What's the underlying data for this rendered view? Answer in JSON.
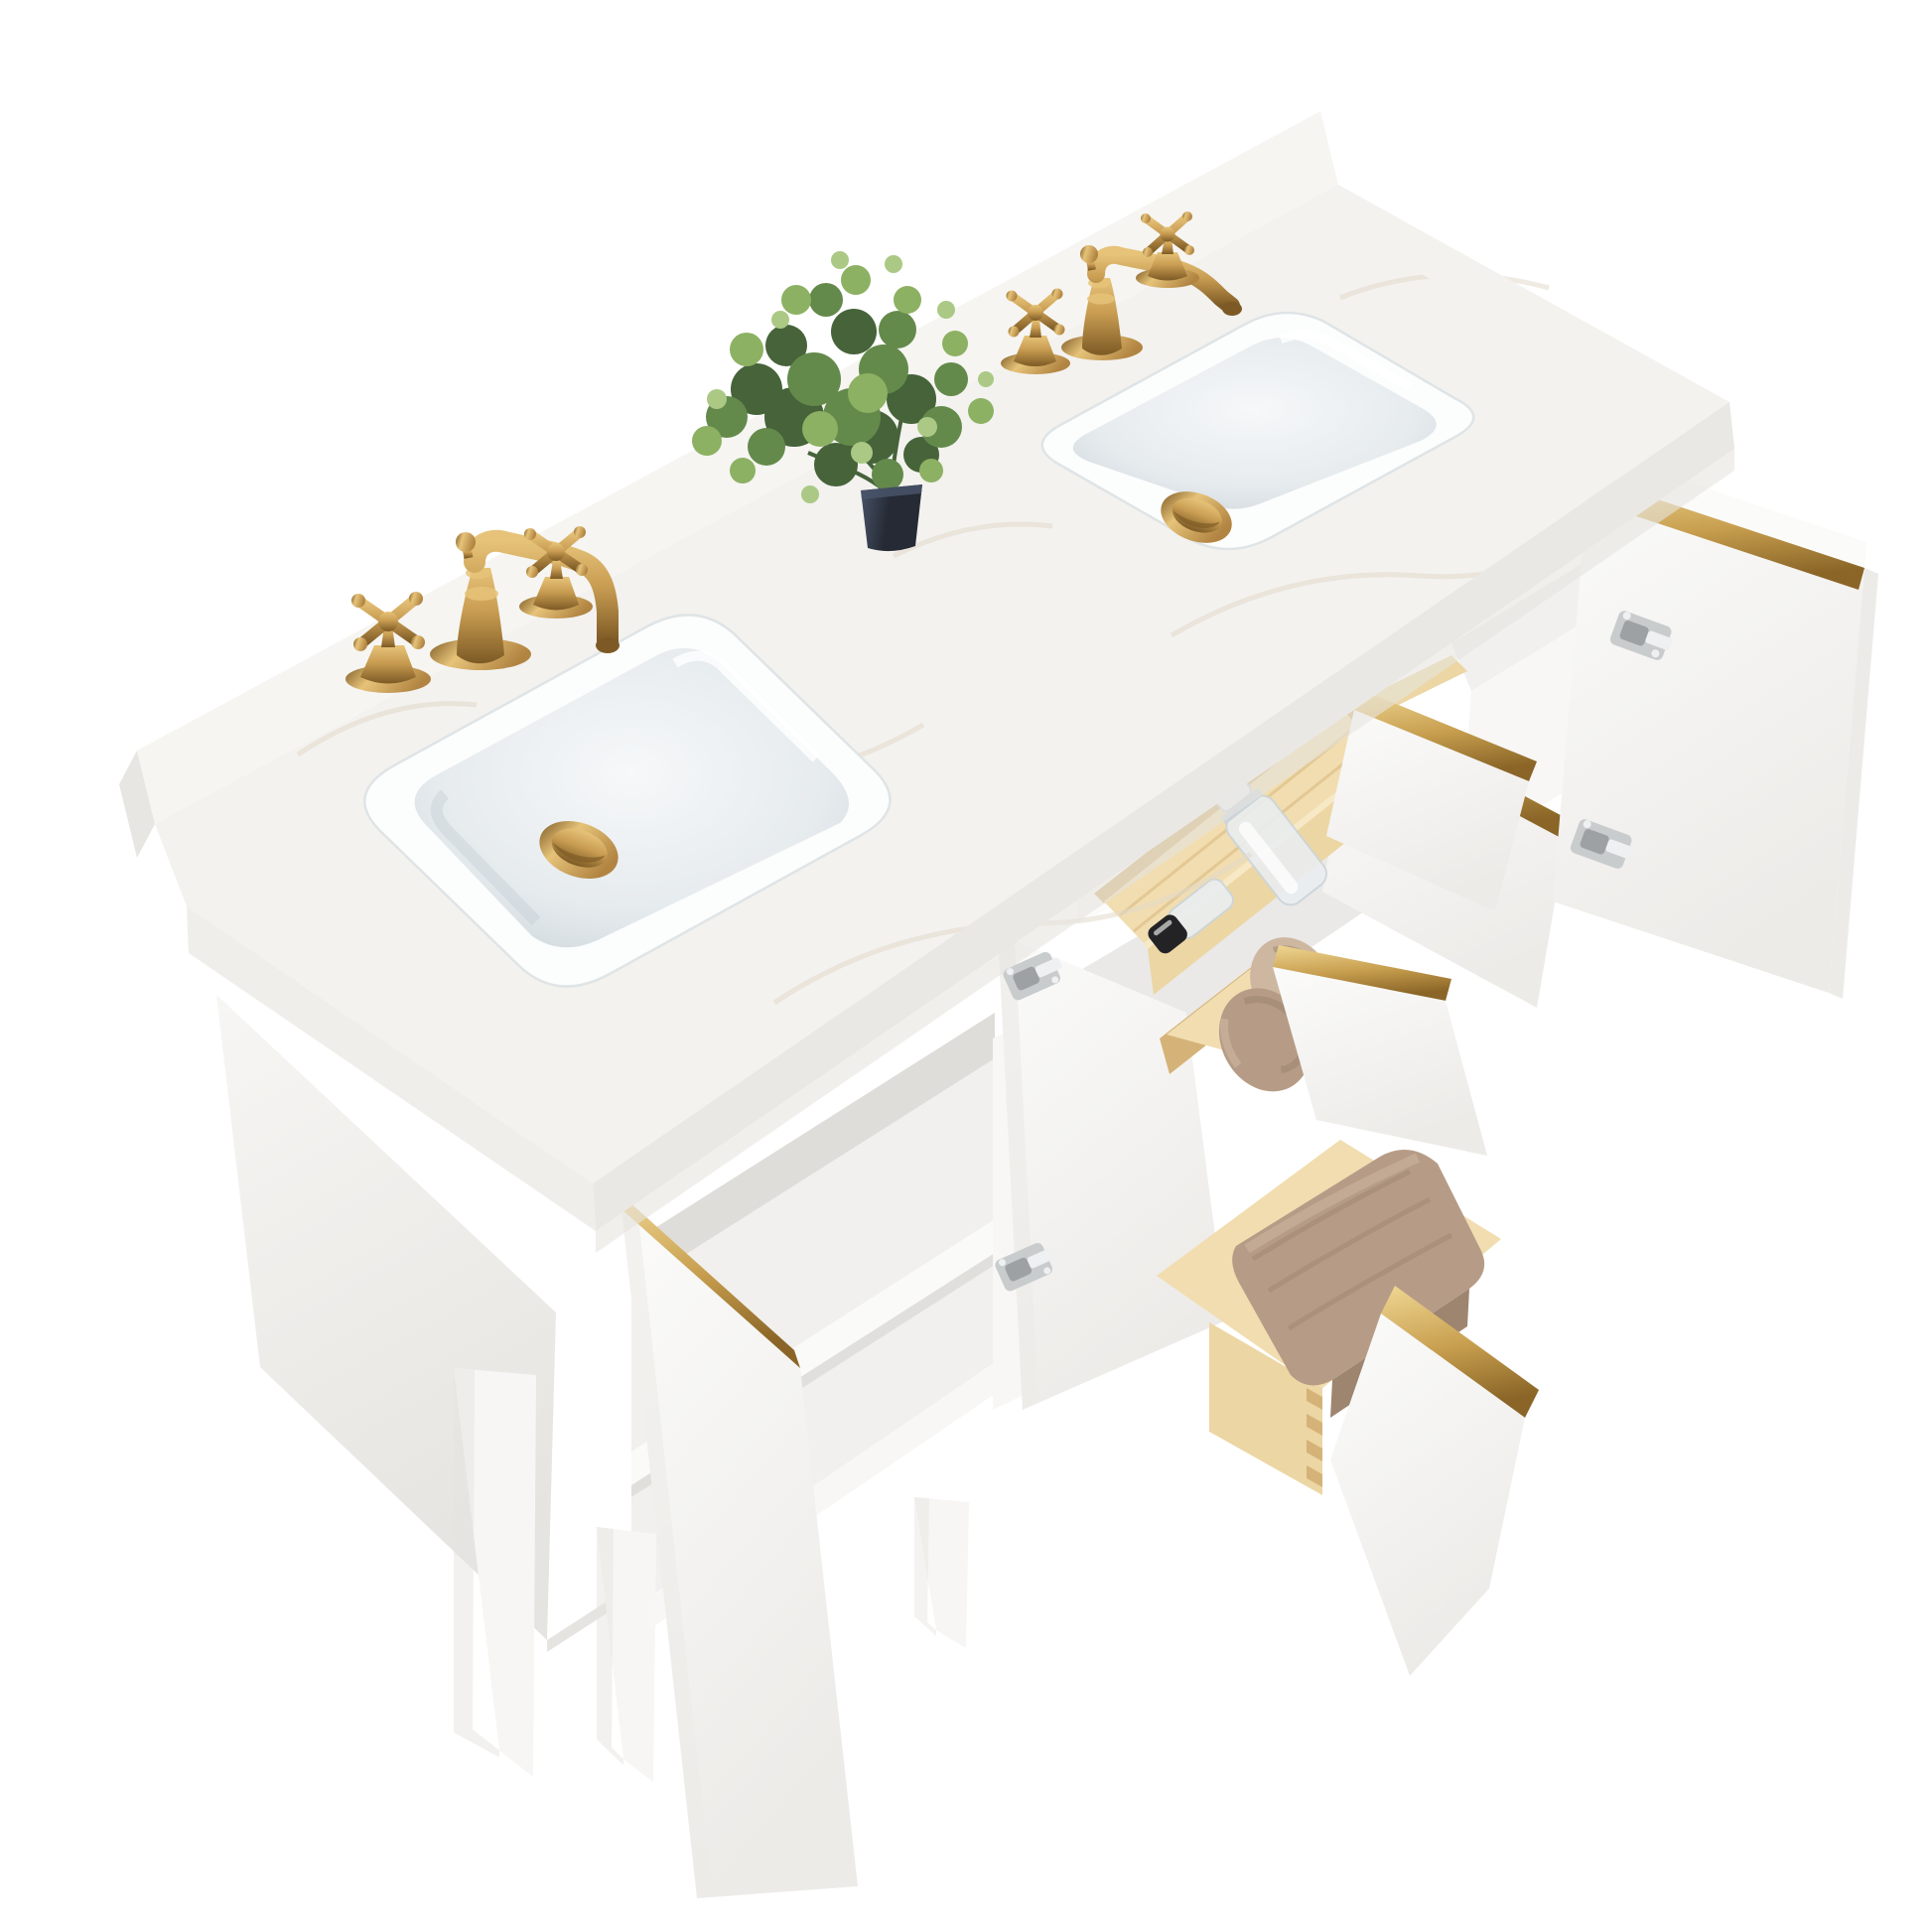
{
  "meta": {
    "title": "Product photo: white double-sink bathroom vanity with marble top, brushed gold faucets, open doors and drawers with towels, and a small green plant",
    "scene_type": "furniture-product-render",
    "background": "#ffffff"
  },
  "scene": {
    "objects": [
      "marble-countertop",
      "marble-backsplash",
      "left-undermount-sink",
      "right-undermount-sink",
      "left-gold-widespread-faucet",
      "right-gold-widespread-faucet",
      "gold-popup-drain-left",
      "gold-popup-drain-right",
      "potted-plant",
      "white-cabinet-body",
      "open-left-door",
      "open-middle-door",
      "open-inner-right-door",
      "open-right-door",
      "top-drawer-with-wood-tray",
      "glass-perfume-bottle",
      "black-cap-bottle",
      "middle-drawer-with-rolled-towels",
      "bottom-drawer-with-folded-towel",
      "nickel-euro-hinges",
      "gold-edge-trims",
      "tapered-legs",
      "interior-shelf"
    ],
    "materials": {
      "counter": "white engineered marble with faint warm veining",
      "cabinet": "matte white lacquer with brushed gold edge trim",
      "drawers": "natural pine boxes with dovetail joints",
      "hardware": "brushed gold / satin nickel hinges",
      "textiles": "taupe cotton towels"
    }
  },
  "palette": {
    "bg": "#ffffff",
    "marbleTop": "#f3f2ef",
    "marbleLight": "#faf9f7",
    "marbleVein": "#e2d9ca",
    "splash": "#f6f5f2",
    "splashCap": "#e8e6e2",
    "edgeFront": "#eae8e4",
    "edgeLeft": "#f0eeea",
    "edgeRight": "#f4f2ee",
    "sinkRim": "#fcfdfd",
    "sinkRimLine": "#dfe4e6",
    "bowl": "#e6ebee",
    "bowlDeep": "#c9d2d7",
    "bowlLight": "#f6f8f9",
    "gold": "#b18441",
    "goldLight": "#e6c379",
    "goldMid": "#c99d52",
    "goldDark": "#7d5a25",
    "trim": "#c79e4e",
    "trimLight": "#f0d793",
    "trimDark": "#8a6527",
    "cabinet": "#f7f6f4",
    "cabinetDeep": "#e6e4e0",
    "door": "#fbfbfa",
    "doorShade": "#edebe8",
    "interior": "#f1f0ee",
    "interiorShadow": "#d6d4d0",
    "shelf": "#fafaf8",
    "stile": "#f8f7f5",
    "pine": "#ecd6a4",
    "pineLight": "#f7e9c6",
    "pineDark": "#d5b378",
    "pineFloor": "#f1ddb0",
    "towel": "#b69c86",
    "towelDark": "#9d8570",
    "towelLight": "#cdb7a1",
    "hinge": "#c9cccd",
    "hingeDark": "#9da1a3",
    "hingeLight": "#eef0f1",
    "pot": "#252a34",
    "potLight": "#49546a",
    "leafDark": "#46633a",
    "leafMid": "#648a4b",
    "leafLight": "#8cb163",
    "leafPale": "#abc985",
    "glass": "#eaeef1",
    "glassLine": "#ccd5da",
    "black": "#232326",
    "white": "#ffffff"
  }
}
